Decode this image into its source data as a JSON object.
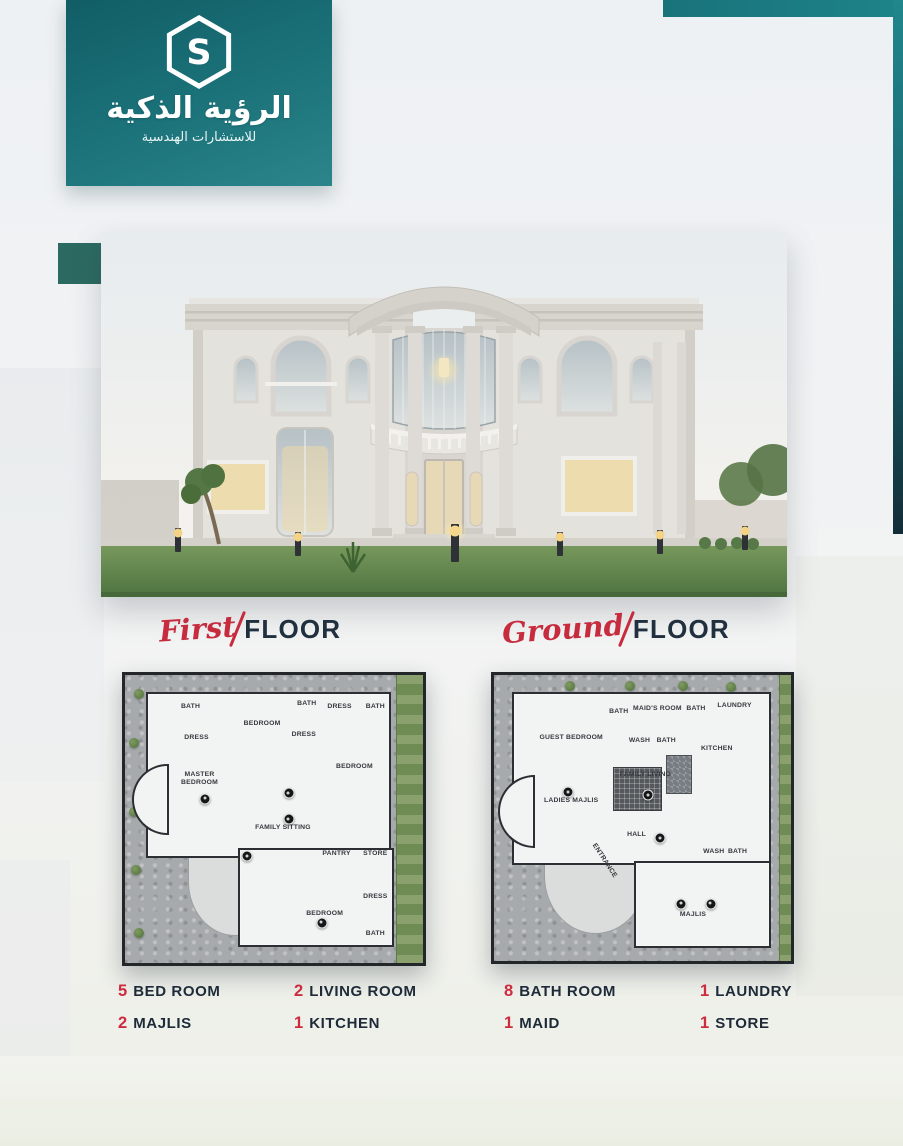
{
  "logo": {
    "brand_ar": "الرؤية الذكية",
    "tagline_ar": "للاستشارات الهندسية",
    "monogram": "S"
  },
  "colors": {
    "teal": "#1b7a81",
    "teal_dark": "#14565f",
    "accent_square": "#2c6a61",
    "red": "#c62b3e",
    "navy": "#1e2a38",
    "background": "#eef1f4"
  },
  "floors": [
    {
      "id": "first",
      "title_script": "First",
      "title_rest": "FLOOR",
      "rooms": [
        {
          "label": "BATH",
          "x": 22,
          "y": 11
        },
        {
          "label": "DRESS",
          "x": 24,
          "y": 22
        },
        {
          "label": "BEDROOM",
          "x": 46,
          "y": 17
        },
        {
          "label": "BATH",
          "x": 61,
          "y": 10
        },
        {
          "label": "DRESS",
          "x": 60,
          "y": 21
        },
        {
          "label": "DRESS",
          "x": 72,
          "y": 11
        },
        {
          "label": "BATH",
          "x": 84,
          "y": 11
        },
        {
          "label": "BEDROOM",
          "x": 77,
          "y": 32
        },
        {
          "label": "MASTER BEDROOM",
          "x": 25,
          "y": 36,
          "w": 46
        },
        {
          "label": "FAMILY SITTING",
          "x": 53,
          "y": 53
        },
        {
          "label": "PANTRY",
          "x": 71,
          "y": 62
        },
        {
          "label": "STORE",
          "x": 84,
          "y": 62
        },
        {
          "label": "BEDROOM",
          "x": 67,
          "y": 83
        },
        {
          "label": "DRESS",
          "x": 84,
          "y": 77
        },
        {
          "label": "BATH",
          "x": 84,
          "y": 90
        }
      ],
      "markers": [
        {
          "x": 27,
          "y": 43
        },
        {
          "x": 55,
          "y": 41
        },
        {
          "x": 55,
          "y": 50
        },
        {
          "x": 41,
          "y": 63
        },
        {
          "x": 66,
          "y": 86
        }
      ]
    },
    {
      "id": "ground",
      "title_script": "Ground",
      "title_rest": "FLOOR",
      "rooms": [
        {
          "label": "GUEST BEDROOM",
          "x": 26,
          "y": 22
        },
        {
          "label": "BATH",
          "x": 42,
          "y": 13
        },
        {
          "label": "MAID'S ROOM",
          "x": 55,
          "y": 12
        },
        {
          "label": "BATH",
          "x": 68,
          "y": 12
        },
        {
          "label": "LAUNDRY",
          "x": 81,
          "y": 11
        },
        {
          "label": "WASH",
          "x": 49,
          "y": 23
        },
        {
          "label": "BATH",
          "x": 58,
          "y": 23
        },
        {
          "label": "KITCHEN",
          "x": 75,
          "y": 26
        },
        {
          "label": "FAMILY LIVING",
          "x": 51,
          "y": 35
        },
        {
          "label": "LADIES MAJLIS",
          "x": 26,
          "y": 44
        },
        {
          "label": "HALL",
          "x": 48,
          "y": 56
        },
        {
          "label": "ENTRANCE",
          "x": 37,
          "y": 65,
          "rot": 57
        },
        {
          "label": "WASH",
          "x": 74,
          "y": 62
        },
        {
          "label": "BATH",
          "x": 82,
          "y": 62
        },
        {
          "label": "MAJLIS",
          "x": 67,
          "y": 84
        }
      ],
      "markers": [
        {
          "x": 25,
          "y": 41
        },
        {
          "x": 52,
          "y": 42
        },
        {
          "x": 56,
          "y": 57
        },
        {
          "x": 63,
          "y": 80
        },
        {
          "x": 73,
          "y": 80
        }
      ]
    }
  ],
  "stats": {
    "items": [
      {
        "num": "5",
        "label": "BED ROOM"
      },
      {
        "num": "2",
        "label": "LIVING ROOM"
      },
      {
        "num": "8",
        "label": "BATH ROOM"
      },
      {
        "num": "1",
        "label": "LAUNDRY"
      },
      {
        "num": "2",
        "label": "MAJLIS"
      },
      {
        "num": "1",
        "label": "KITCHEN"
      },
      {
        "num": "1",
        "label": "MAID"
      },
      {
        "num": "1",
        "label": "STORE"
      }
    ]
  }
}
